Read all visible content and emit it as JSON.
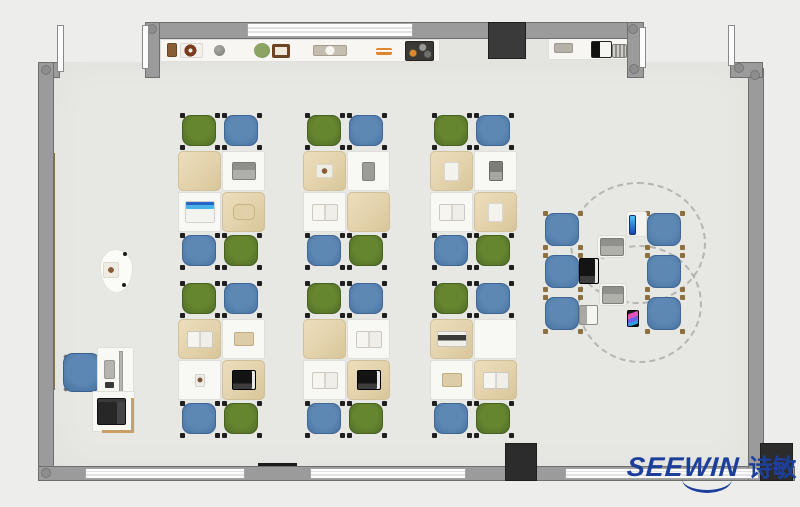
{
  "logo": {
    "text": "SEEWIN",
    "cn": "诗敏",
    "color": "#1b3f9a",
    "pos": [
      627,
      448
    ],
    "swoosh": [
      55,
      31,
      50,
      11
    ]
  },
  "palette": {
    "floor": "#e7e7e4",
    "outside": "#ededec",
    "wall": "#9b9b9b",
    "chair_green": "#5d7b2d",
    "chair_blue": "#5380ad",
    "desk_cover": "#e3d2ab",
    "accent_green_board": "#35d593",
    "wood_panel": "#8b6f4a",
    "logo_blue": "#1b3f9a"
  },
  "floorplan": {
    "floor": [
      [
        53,
        62,
        697,
        406
      ],
      [
        160,
        36,
        483,
        30
      ]
    ],
    "counters": [
      [
        160,
        39,
        280,
        23
      ],
      [
        548,
        36,
        82,
        24
      ]
    ],
    "wall_strips": [
      {
        "kind": "wood",
        "box": [
          50,
          153,
          5,
          237
        ],
        "color": "#8b6f4a"
      },
      {
        "kind": "wood",
        "box": [
          748,
          163,
          5,
          53
        ],
        "color": "#7d6f52"
      },
      {
        "kind": "green",
        "box": [
          748,
          216,
          5,
          160
        ],
        "color": "#35d593"
      }
    ],
    "walls": [
      [
        150,
        22,
        494,
        17
      ],
      [
        145,
        22,
        15,
        56
      ],
      [
        38,
        62,
        22,
        16
      ],
      [
        38,
        62,
        16,
        419
      ],
      [
        38,
        466,
        757,
        15
      ],
      [
        748,
        68,
        16,
        413
      ],
      [
        730,
        62,
        33,
        16
      ],
      [
        627,
        22,
        17,
        56
      ]
    ],
    "windows": [
      [
        247,
        23,
        166,
        14
      ],
      [
        85,
        468,
        160,
        11
      ],
      [
        310,
        468,
        156,
        11
      ],
      [
        565,
        468,
        194,
        11
      ]
    ],
    "joints": [
      [
        41,
        65
      ],
      [
        147,
        24
      ],
      [
        628,
        24
      ],
      [
        629,
        64
      ],
      [
        734,
        63
      ],
      [
        750,
        70
      ],
      [
        41,
        468
      ]
    ],
    "pillars": [
      {
        "box": [
          488,
          22,
          38,
          37
        ],
        "color": "#3a3a3a"
      },
      {
        "box": [
          505,
          443,
          32,
          38
        ],
        "color": "#2c2c2c"
      },
      {
        "box": [
          760,
          443,
          33,
          38
        ],
        "color": "#2c2c2c"
      }
    ],
    "doors": [
      [
        57,
        25,
        7,
        47
      ],
      [
        142,
        25,
        7,
        44
      ],
      [
        639,
        27,
        7,
        41
      ],
      [
        728,
        25,
        7,
        41
      ]
    ],
    "accents": [
      {
        "box": [
          258,
          463,
          39,
          4
        ],
        "color": "#1c1c1c"
      }
    ],
    "clusters": [
      {
        "x": 178,
        "y": 115,
        "items": [
          "none",
          "laptop-gray",
          "laptop-blue",
          "bag-tan"
        ]
      },
      {
        "x": 303,
        "y": 115,
        "items": [
          "paper-brown",
          "tablet-gray",
          "book-open",
          "none"
        ]
      },
      {
        "x": 430,
        "y": 115,
        "items": [
          "paper-white",
          "tablet-dark",
          "book-open",
          "paper-white"
        ]
      },
      {
        "x": 178,
        "y": 283,
        "items": [
          "book-open",
          "book-tan",
          "photo",
          "laptop-dark"
        ]
      },
      {
        "x": 303,
        "y": 283,
        "items": [
          "none",
          "book-open",
          "book-open",
          "laptop-dark"
        ]
      },
      {
        "x": 430,
        "y": 283,
        "items": [
          "tray-items",
          "none",
          "book-tan",
          "book-open"
        ]
      }
    ],
    "discussion": {
      "chairs": [
        [
          545,
          213,
          34,
          33
        ],
        [
          647,
          213,
          34,
          33
        ],
        [
          545,
          255,
          34,
          33
        ],
        [
          647,
          255,
          34,
          33
        ],
        [
          545,
          297,
          34,
          33
        ],
        [
          647,
          297,
          34,
          33
        ]
      ],
      "circles": [
        [
          570,
          182,
          136,
          122
        ],
        [
          578,
          245,
          124,
          118
        ]
      ],
      "items": [
        [
          "pad",
          626,
          211,
          21,
          26
        ],
        [
          "tablet-blue",
          629,
          215,
          7,
          20
        ],
        [
          "pad",
          597,
          235,
          29,
          23
        ],
        [
          "laptop-gray",
          600,
          238,
          24,
          18
        ],
        [
          "laptop-dark",
          579,
          258,
          20,
          26
        ],
        [
          "pad",
          599,
          283,
          28,
          23
        ],
        [
          "laptop-gray",
          602,
          286,
          22,
          18
        ],
        [
          "laptop-small",
          579,
          305,
          19,
          20
        ],
        [
          "phone-colorful",
          627,
          310,
          12,
          17
        ]
      ]
    },
    "teacher": {
      "podium": [
        100,
        249,
        33,
        44
      ],
      "podium_item": [
        103,
        262,
        16,
        16
      ],
      "podium_dots": [
        [
          123,
          252
        ],
        [
          122,
          283
        ]
      ],
      "desk": [
        97,
        347,
        37,
        47
      ],
      "monitor": [
        119,
        351,
        4,
        41
      ],
      "keyboard": [
        104,
        360,
        11,
        19
      ],
      "small_item": [
        105,
        382,
        9,
        6
      ],
      "chair": [
        63,
        353,
        38,
        39
      ],
      "printer_desk": [
        92,
        391,
        43,
        41
      ],
      "printer": [
        97,
        398,
        29,
        27
      ],
      "partitions": [
        [
          131,
          398,
          3,
          34
        ],
        [
          102,
          430,
          32,
          3
        ]
      ]
    },
    "counter_items": [
      [
        "box-brown",
        167,
        43,
        10,
        14
      ],
      [
        "donut-tray",
        180,
        43,
        23,
        15
      ],
      [
        "sphere",
        214,
        45,
        11,
        11
      ],
      [
        "plant",
        254,
        43,
        16,
        15
      ],
      [
        "frame",
        272,
        44,
        18,
        14
      ],
      [
        "cup-tray",
        313,
        45,
        34,
        11
      ],
      [
        "orange-lines",
        376,
        48,
        16,
        7
      ],
      [
        "toolbox",
        405,
        41,
        29,
        20
      ],
      [
        "tray",
        554,
        43,
        19,
        10
      ],
      [
        "device-bw",
        591,
        41,
        21,
        17
      ],
      [
        "grill",
        612,
        44,
        15,
        14
      ]
    ]
  }
}
